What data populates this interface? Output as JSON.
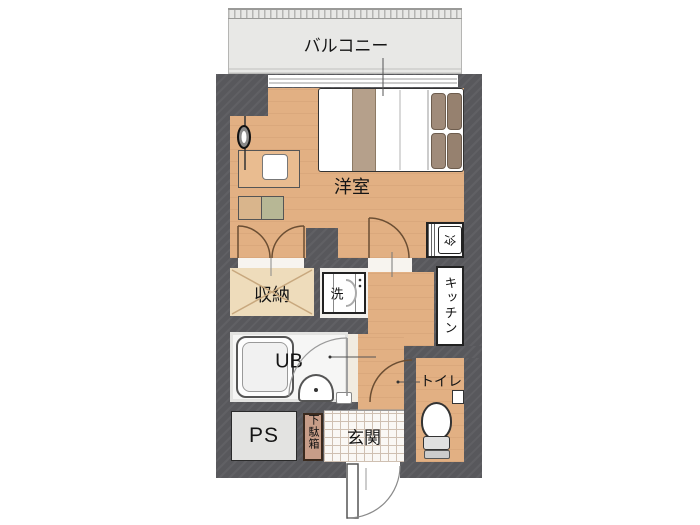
{
  "floorplan": {
    "labels": {
      "balcony": "バルコニー",
      "western_room": "洋室",
      "storage": "収納",
      "washer": "洗",
      "fridge": "冷",
      "kitchen": "キッチン",
      "unit_bath": "UB",
      "toilet": "トイレ",
      "pipe_space": "PS",
      "shoe_box": "下駄箱",
      "entrance": "玄関"
    },
    "colors": {
      "wall": "#58585c",
      "wood_floor": "#e2b083",
      "closet_floor": "#eedcbb",
      "balcony_floor": "#e8e8e6",
      "tile_floor": "#faf8f5",
      "ps_fill": "#e3e3e1",
      "shoe_box_fill": "#c79d88",
      "pillow": "#a08b7a",
      "blanket_band": "#b5a08b",
      "cabinet_accent": "#b7b795"
    }
  }
}
